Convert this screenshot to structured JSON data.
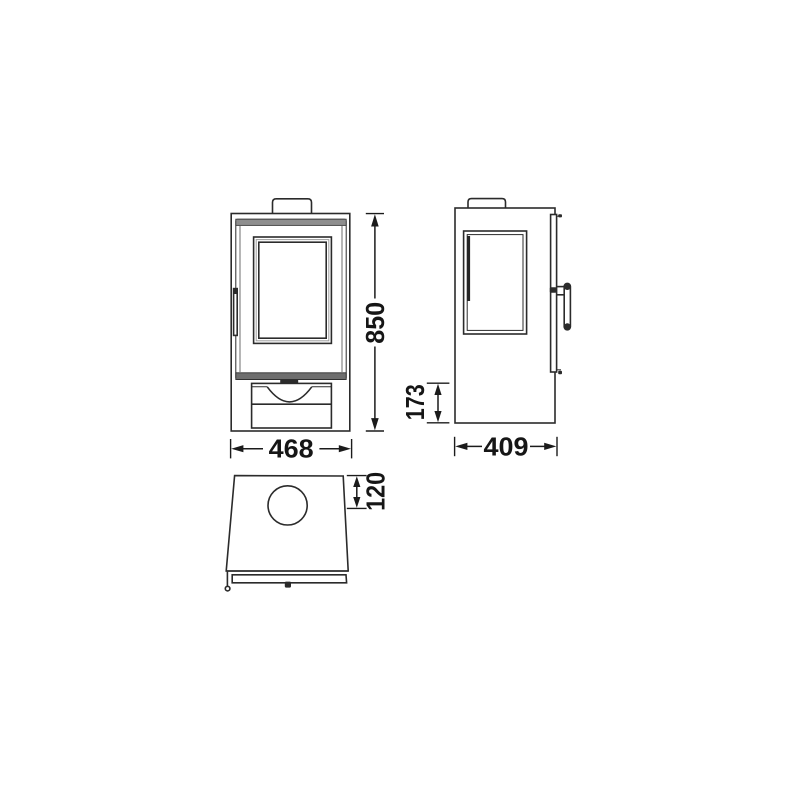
{
  "colors": {
    "background": "#ffffff",
    "line": "#2b2b2b",
    "dimension_text": "#161616",
    "trim_gray": "#8e8e8e"
  },
  "dimensions": {
    "height": "850",
    "width": "468",
    "depth": "409",
    "base_height": "173",
    "flue_offset": "120"
  }
}
